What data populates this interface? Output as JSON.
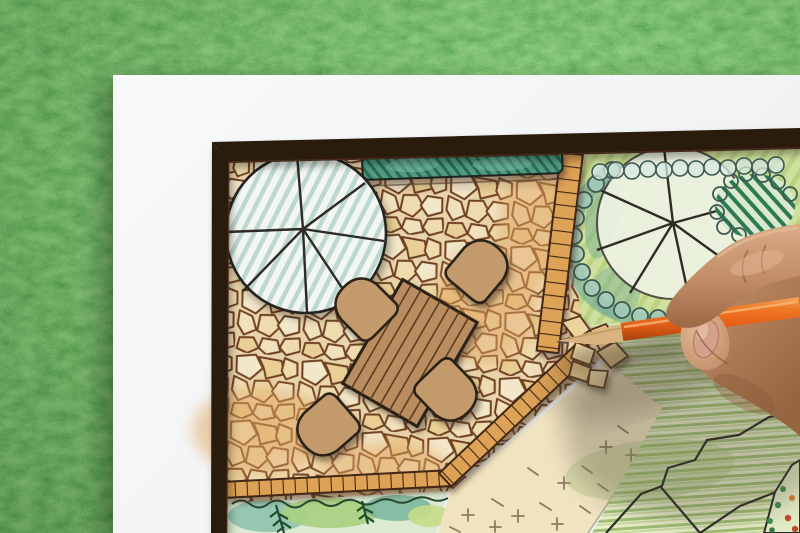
{
  "scene": {
    "type": "photograph",
    "description": "Overhead photo of a hand drawing a landscape garden design plan with an orange colored pencil. The white plan sheet lies on green grass. The plan shows a flagstone patio with a wooden dining table and four chairs, tree canopy symbols, a hedge, tile edging strips, a hatched lawn, ground-cover beds and shrub masses.",
    "subject": "landscape architect garden plan drawing",
    "objects": [
      "grass background",
      "white plan sheet",
      "dark plan border",
      "flagstone patio",
      "deciduous tree symbol (striped)",
      "deciduous tree symbol (green)",
      "hedge strip",
      "dining table",
      "four chairs",
      "tile edging borders",
      "striped lawn",
      "ground-cover area with cross marks",
      "planting bed with ferns",
      "corner planting bed with dots",
      "hand holding orange colored pencil"
    ]
  },
  "colors": {
    "grass_base": "#41692f",
    "paper": "#f5f7f8",
    "plan_border": "#2a1a10",
    "plan_border_edge": "#5a3424",
    "stone_bg": "#e9d5ab",
    "stone_1": "#f2e7c9",
    "stone_2": "#eedcae",
    "stone_3": "#e9cf96",
    "stone_4": "#f0e0bb",
    "stone_warm": "#e2a65e",
    "stone_joint": "#6f4023",
    "tile": "#dda257",
    "tile_joint": "#422812",
    "table_wood": "#b98d5e",
    "plank_line": "#5d3c22",
    "chair_wood": "#c39a6c",
    "outline_dark": "#2b2015",
    "hedge_green": "#4f9c80",
    "hedge_dark": "#2b6a55",
    "tree_bg": "#f3f6f1",
    "tree_stripe": "#b9d6cf",
    "garden_bg": "#cfdf9c",
    "garden_hatch": "#b7cf80",
    "lawn_bg": "#e9efcc",
    "lawn_stripe": "#a4c176",
    "teal_shrub": "#70a895",
    "scallop_line": "#3c5a52",
    "shrub_dark": "#2e7b50",
    "bed_wash": "#dcead2",
    "bed_teal": "#8fc2ae",
    "bed_fern": "#1e4f2c",
    "crosshatch_bg": "#f0e3c0",
    "crosshatch_mark": "#8b7d62",
    "pencil_orange": "#ec6a1c",
    "pencil_orange_dark": "#b8490f",
    "pencil_wood": "#d9b47e",
    "pencil_lead": "#4e4a43",
    "skin_light": "#dcae8b",
    "skin_mid": "#bd8a64",
    "skin_shadow": "#8f5b3e",
    "nail": "#d3a18c",
    "cast_shadow": "#4a4030"
  }
}
